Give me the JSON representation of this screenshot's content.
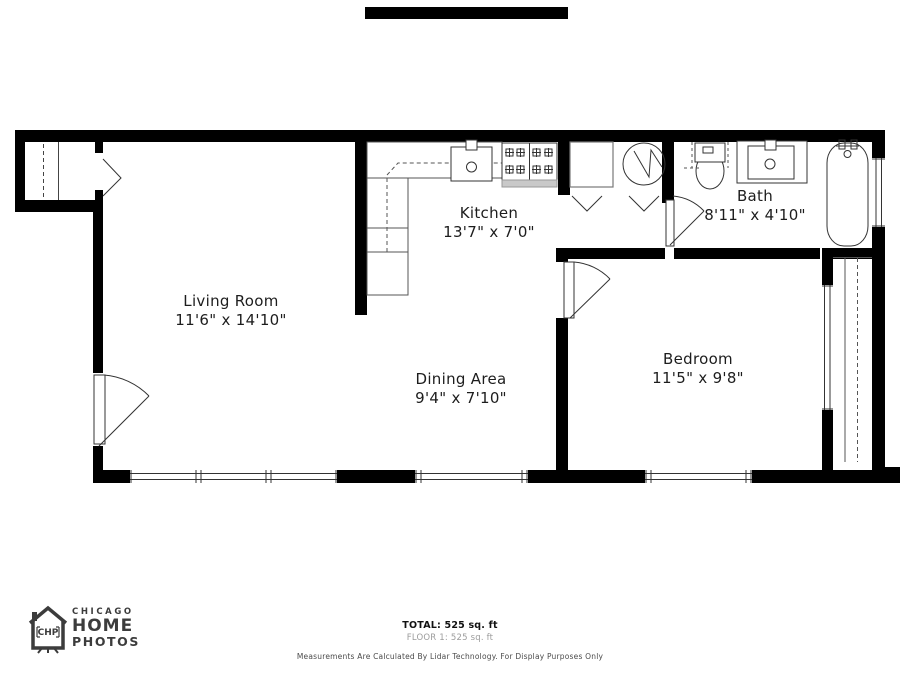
{
  "rooms": [
    {
      "id": "living-room",
      "name": "Living Room",
      "dims": "11'6\" x 14'10\""
    },
    {
      "id": "kitchen",
      "name": "Kitchen",
      "dims": "13'7\" x 7'0\""
    },
    {
      "id": "dining-area",
      "name": "Dining Area",
      "dims": "9'4\" x 7'10\""
    },
    {
      "id": "bedroom",
      "name": "Bedroom",
      "dims": "11'5\" x 9'8\""
    },
    {
      "id": "bath",
      "name": "Bath",
      "dims": "8'11\" x 4'10\""
    }
  ],
  "footer": {
    "total": "TOTAL: 525 sq. ft",
    "floor": "FLOOR 1: 525 sq. ft",
    "disclaimer": "Measurements Are Calculated By Lidar Technology. For Display Purposes Only"
  },
  "logo": {
    "line1": "CHICAGO",
    "line2": "HOME",
    "line3": "PHOTOS",
    "badge": "CHP"
  },
  "colors": {
    "wall": "#000000",
    "fixture_line": "#333333",
    "counter_line": "#555555",
    "stove_strip": "#c9c9c9",
    "logo": "#3c3c3c",
    "muted_text": "#9c9c9c"
  }
}
